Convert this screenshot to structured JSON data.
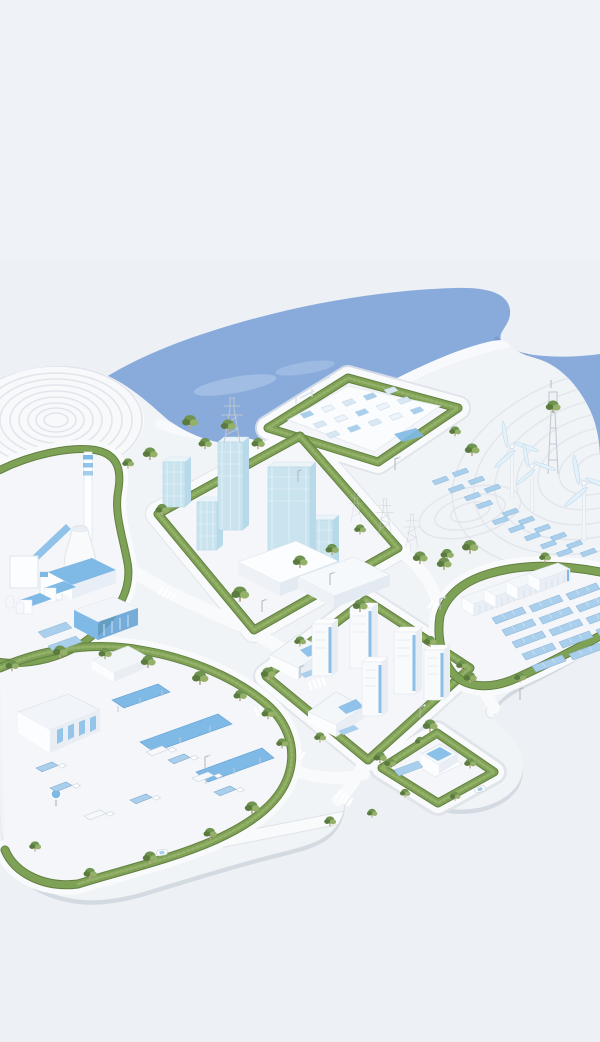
{
  "illustration": {
    "type": "isometric-3d-render",
    "subject": "sustainable smart industrial park on a waterfront",
    "areas": [
      {
        "name": "water-bay"
      },
      {
        "name": "terraced-crop-field"
      },
      {
        "name": "electrical-substation-district"
      },
      {
        "name": "industrial-plant-district"
      },
      {
        "name": "downtown-office-district"
      },
      {
        "name": "wind-turbines",
        "count": 3
      },
      {
        "name": "telecom-tower"
      },
      {
        "name": "solar-panel-hillside"
      },
      {
        "name": "battery-storage-yard",
        "container_count": 4
      },
      {
        "name": "ground-solar-farm"
      },
      {
        "name": "residential-district"
      },
      {
        "name": "logistics-depot-district"
      },
      {
        "name": "ev-charging-station-district"
      },
      {
        "name": "road-network-with-crosswalks"
      }
    ]
  },
  "colors": {
    "background": "#edf0f5",
    "water": "#88abdc",
    "water_shade": "#7494c6",
    "land": "#f1f4f7",
    "plot": "#f4f6f9",
    "land_edge": "#d4dae1",
    "road": "#f8fafc",
    "curb": "#dfe3e9",
    "hedge": "#7da155",
    "hedge_dark": "#647f41",
    "hedge_light": "#95b169",
    "tree": "#6f9450",
    "tree_dark": "#5a7a3e",
    "glass": "#c9e3ef",
    "glass_top": "#e9f3f8",
    "glass_side": "#b7d9e9",
    "accent_blue": "#7fb9e6",
    "accent_deep": "#5f9fd4",
    "panel_blue": "#aacfec",
    "white": "#fbfdfe",
    "white_side": "#e7edf3",
    "shade": "#dfe5ec",
    "contour": "#e2e6ec",
    "metal": "#c2c9d2"
  }
}
